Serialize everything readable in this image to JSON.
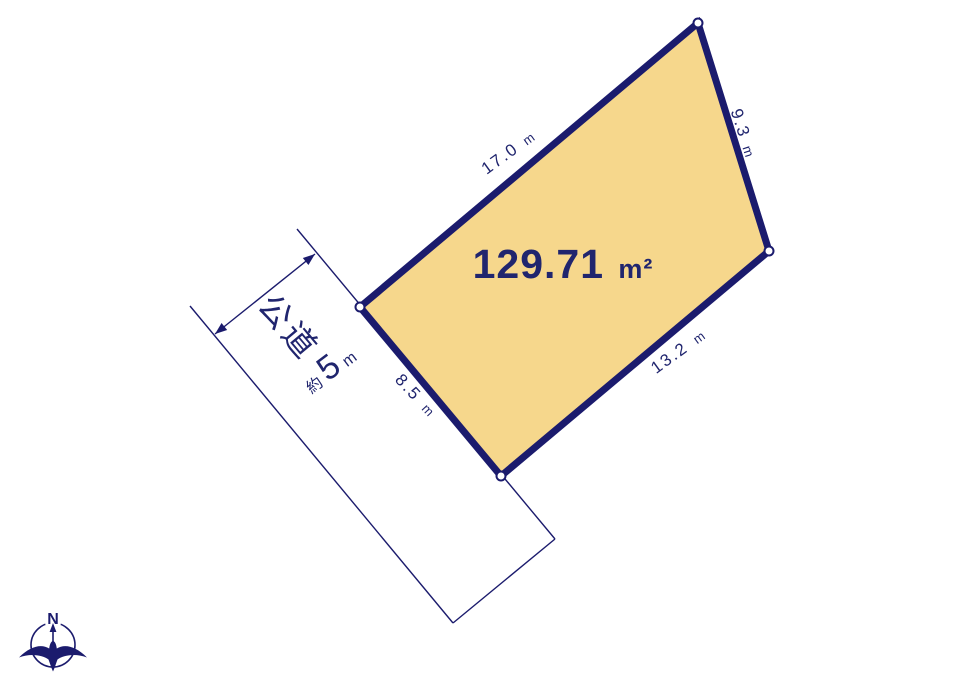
{
  "parcel": {
    "area_value": "129.71",
    "area_unit": "m²",
    "fill_color": "#f6d78c",
    "outline_color": "#1b1b6d",
    "sides": {
      "top_left": {
        "value": "17.0",
        "unit": "m"
      },
      "right": {
        "value": "9.3",
        "unit": "m"
      },
      "bottom_right": {
        "value": "13.2",
        "unit": "m"
      },
      "bottom_left": {
        "value": "8.5",
        "unit": "m"
      }
    }
  },
  "road": {
    "name": "公道",
    "width_prefix": "約",
    "width_value": "5",
    "width_unit": "m"
  },
  "compass": {
    "north_label": "N"
  },
  "colors": {
    "line_navy": "#1b1b6d",
    "text_navy": "#20256e",
    "background": "#ffffff"
  }
}
